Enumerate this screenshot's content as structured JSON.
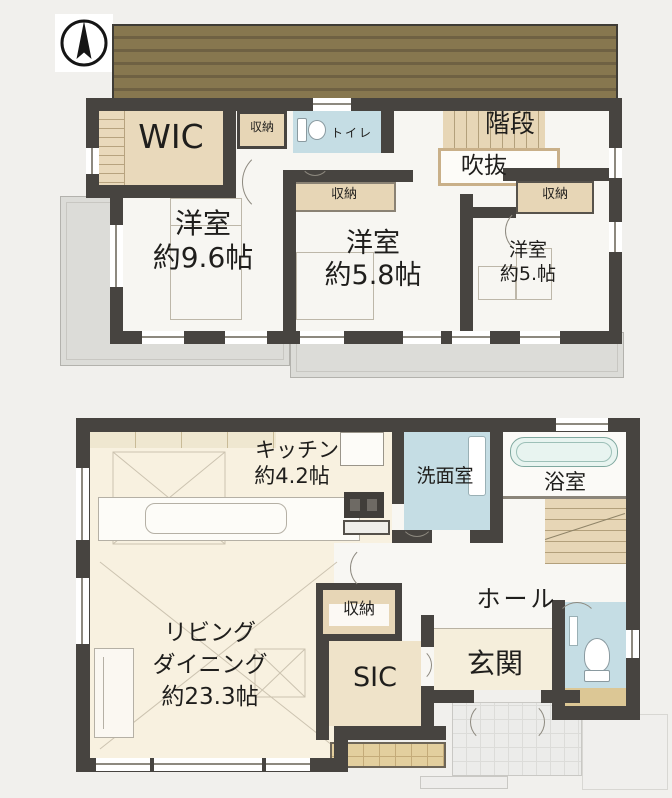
{
  "palette": {
    "wall": "#474440",
    "roof_light": "#87774f",
    "roof_dark": "#6f6143",
    "tan": "#e7d6b6",
    "cream": "#f8f1e0",
    "wet_blue": "#c5dde4",
    "gray_roof": "#dcdcd8",
    "porch_gray": "#ececea",
    "deck_tan": "#e3cf9e"
  },
  "floor2": {
    "wic_label": "WIC",
    "closet_a_label": "収納",
    "toilet_label": "トイレ",
    "stairs_label": "階段",
    "void_label": "吹抜",
    "closet_b_label": "収納",
    "closet_c_label": "収納",
    "bedroom1": {
      "name": "洋室",
      "size": "約9.6帖"
    },
    "bedroom2": {
      "name": "洋室",
      "size": "約5.8帖"
    },
    "bedroom3": {
      "name": "洋室",
      "size": "約5.帖"
    }
  },
  "floor1": {
    "kitchen": {
      "name": "キッチン",
      "size": "約4.2帖"
    },
    "washroom_label": "洗面室",
    "bath_label": "浴室",
    "hall_label": "ホール",
    "closet_label": "収納",
    "living": {
      "line1": "リビング",
      "line2": "ダイニング",
      "size": "約23.3帖"
    },
    "sic_label": "SIC",
    "entrance_label": "玄関"
  }
}
